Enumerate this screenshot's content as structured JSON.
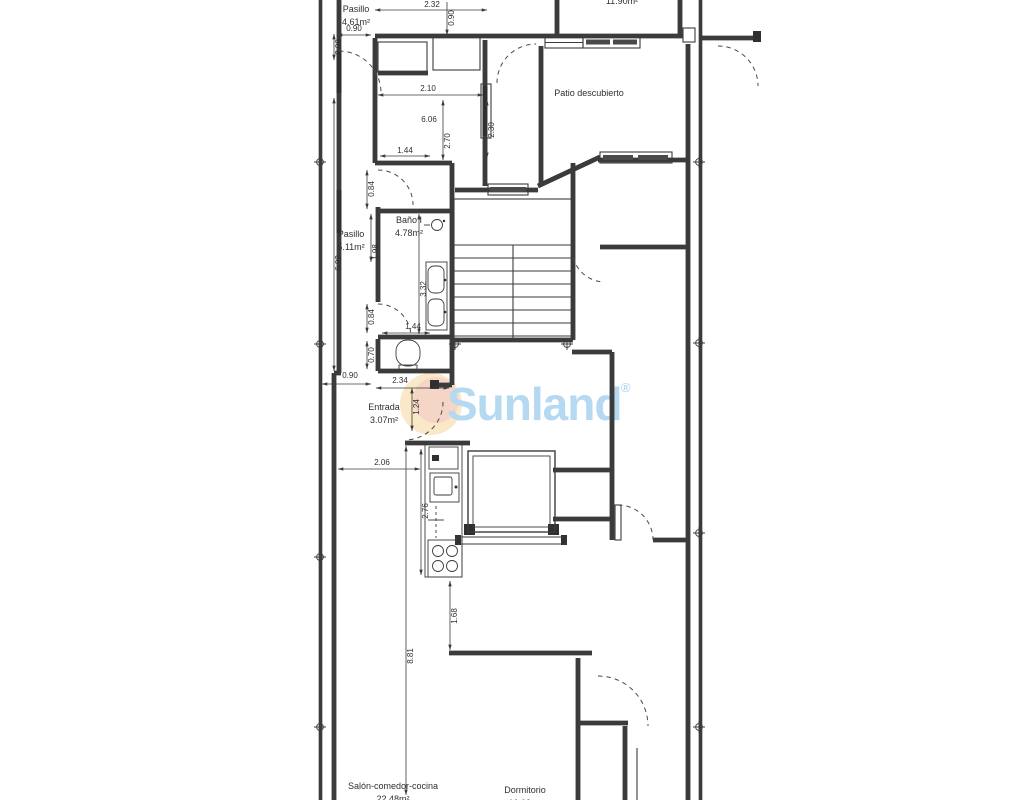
{
  "watermark": {
    "brand": "Sunland",
    "mark": "®",
    "brand_color": "#b5d9f1",
    "sun_outer_color": "#fbe8c8",
    "sun_inner_color": "#f3cfc6"
  },
  "plan": {
    "room_labels": [
      {
        "id": "pasillo-top",
        "lines": [
          "Pasillo",
          "4.61m²"
        ],
        "x": 356,
        "y": 12
      },
      {
        "id": "top-room-clipped",
        "lines": [
          "11.90m²"
        ],
        "x": 622,
        "y": 4
      },
      {
        "id": "patio-descubierto",
        "lines": [
          "Patio descubierto"
        ],
        "x": 589,
        "y": 96
      },
      {
        "id": "bano-1",
        "lines": [
          "Baño I",
          "4.78m²"
        ],
        "x": 409,
        "y": 223
      },
      {
        "id": "pasillo-mid",
        "lines": [
          "Pasillo",
          "5.11m²"
        ],
        "x": 351,
        "y": 237
      },
      {
        "id": "entrada",
        "lines": [
          "Entrada",
          "3.07m²"
        ],
        "x": 384,
        "y": 410
      },
      {
        "id": "salon-comedor-cocina",
        "lines": [
          "Salón-comedor-cocina",
          "22.48m²"
        ],
        "x": 393,
        "y": 789
      },
      {
        "id": "dormitorio",
        "lines": [
          "Dormitorio",
          "10.08m²"
        ],
        "x": 525,
        "y": 793
      }
    ],
    "dimensions": [
      {
        "t": "2.32",
        "x": 432,
        "y": 7,
        "r": 0
      },
      {
        "t": "0.90",
        "x": 451,
        "y": 18,
        "r": 1
      },
      {
        "t": "0.90",
        "x": 354,
        "y": 31,
        "r": 0
      },
      {
        "t": "2.09",
        "x": 338,
        "y": 47,
        "r": 1
      },
      {
        "t": "2.10",
        "x": 428,
        "y": 91,
        "r": 0
      },
      {
        "t": "6.06",
        "x": 429,
        "y": 122,
        "r": 0
      },
      {
        "t": "2.70",
        "x": 447,
        "y": 141,
        "r": 1
      },
      {
        "t": "2.30",
        "x": 491,
        "y": 130,
        "r": 1
      },
      {
        "t": "1.44",
        "x": 405,
        "y": 153,
        "r": 0
      },
      {
        "t": "0.84",
        "x": 371,
        "y": 189,
        "r": 1
      },
      {
        "t": "1.98",
        "x": 375,
        "y": 252,
        "r": 1
      },
      {
        "t": "6.92",
        "x": 338,
        "y": 263,
        "r": 1
      },
      {
        "t": "3.32",
        "x": 423,
        "y": 289,
        "r": 1
      },
      {
        "t": "0.84",
        "x": 371,
        "y": 317,
        "r": 1
      },
      {
        "t": "1.44",
        "x": 413,
        "y": 329,
        "r": 0
      },
      {
        "t": "0.70",
        "x": 371,
        "y": 355,
        "r": 1
      },
      {
        "t": "0.90",
        "x": 350,
        "y": 378,
        "r": 0
      },
      {
        "t": "2.34",
        "x": 400,
        "y": 383,
        "r": 0
      },
      {
        "t": "1.24",
        "x": 416,
        "y": 407,
        "r": 1
      },
      {
        "t": "2.06",
        "x": 382,
        "y": 465,
        "r": 0
      },
      {
        "t": "2.76",
        "x": 425,
        "y": 511,
        "r": 1
      },
      {
        "t": "1.68",
        "x": 454,
        "y": 616,
        "r": 1
      },
      {
        "t": "8.81",
        "x": 410,
        "y": 656,
        "r": 1
      }
    ]
  }
}
